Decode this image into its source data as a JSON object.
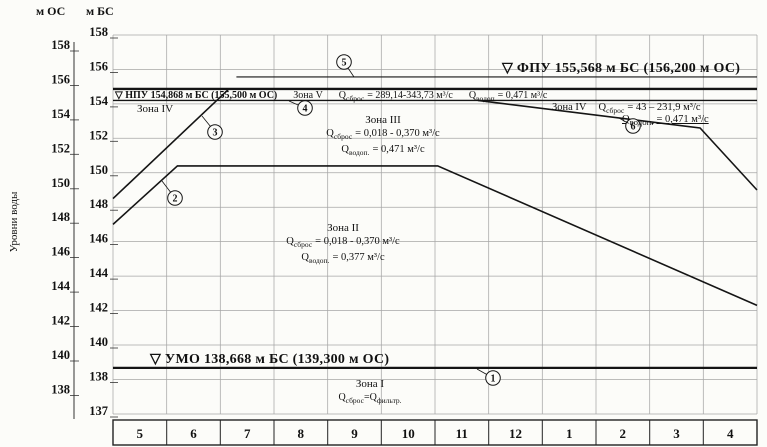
{
  "annotations": {
    "q_letter": "Q",
    "fpu_label": "▽ ФПУ 155,568 м БС (156,200 м ОС)",
    "npu_label": "▽ НПУ 154,868 м БС (155,500 м ОС)",
    "umo_label": "▽ УМО 138,668 м БС (139,300 м ОС)",
    "zone5": {
      "title": "Зона V",
      "q1_sub": "сброс",
      "q1_val": "= 289,14-343,73 м³/с",
      "q2_sub": "водоп",
      "q2_val": "= 0,471 м³/с"
    },
    "zone4_left": {
      "title": "Зона IV"
    },
    "zone4_right": {
      "title": "Зона IV",
      "q1_sub": "сброс",
      "q1_val": "= 43 – 231,9 м³/с",
      "q2_sub": "водоп.",
      "q2_val": "= 0,471 м³/с"
    },
    "zone3": {
      "title": "Зона III",
      "q1_sub": "сброс",
      "q1_val": "= 0,018 - 0,370 м³/с",
      "q2_sub": "водоп.",
      "q2_val": "= 0,471 м³/с"
    },
    "zone2": {
      "title": "Зона II",
      "q1_sub": "сброс",
      "q1_val": "= 0,018 - 0,370 м³/с",
      "q2_sub": "водоп.",
      "q2_val": "= 0,377 м³/с"
    },
    "zone1": {
      "title": "Зона I",
      "q_left_sub": "сброс",
      "eq": "=",
      "q_right_sub": "фильтр."
    }
  },
  "chart_data": {
    "type": "line",
    "title": "Диспетчерский график водохранилища (уровни воды по месяцам)",
    "ylabel": "Уровни воды",
    "y_axis_left": {
      "title": "м ОС",
      "ticks": [
        158,
        156,
        154,
        152,
        150,
        148,
        146,
        144,
        142,
        140,
        138
      ]
    },
    "y_axis_right": {
      "title": "м БС",
      "ticks": [
        158,
        156,
        154,
        152,
        150,
        148,
        146,
        144,
        142,
        140,
        138,
        137
      ]
    },
    "x_axis": {
      "months": [
        "5",
        "6",
        "7",
        "8",
        "9",
        "10",
        "11",
        "12",
        "1",
        "2",
        "3",
        "4"
      ]
    },
    "levels": {
      "FPU_BS": 155.568,
      "FPU_OS": 156.2,
      "NPU_BS": 154.868,
      "NPU_OS": 155.5,
      "UMO_BS": 138.668,
      "UMO_OS": 139.3
    },
    "grid": true,
    "legend": "none",
    "series": [
      {
        "id": "line-1-umo",
        "points": [
          [
            0,
            138.668
          ],
          [
            12,
            138.668
          ]
        ],
        "width": 2.2
      },
      {
        "id": "line-2-lower",
        "points": [
          [
            0,
            147.0
          ],
          [
            1.2,
            150.4
          ],
          [
            6.05,
            150.4
          ],
          [
            12,
            142.3
          ]
        ],
        "width": 1.6
      },
      {
        "id": "line-3-filling",
        "points": [
          [
            0,
            148.5
          ],
          [
            2.16,
            154.868
          ]
        ],
        "width": 1.6
      },
      {
        "id": "line-4-upper",
        "points": [
          [
            0,
            154.2
          ],
          [
            12,
            154.2
          ]
        ],
        "width": 1.4
      },
      {
        "id": "line-5-fpu",
        "points": [
          [
            2.3,
            155.568
          ],
          [
            12,
            155.568
          ]
        ],
        "width": 1.1
      },
      {
        "id": "line-6-zone4",
        "points": [
          [
            6.8,
            154.2
          ],
          [
            10.94,
            152.6
          ],
          [
            12,
            149.0
          ]
        ],
        "width": 1.6
      },
      {
        "id": "line-npu",
        "points": [
          [
            0,
            154.868
          ],
          [
            12,
            154.868
          ]
        ],
        "width": 2.4
      }
    ],
    "markers": [
      {
        "label": "1",
        "cx": 493,
        "cy": 378,
        "lx": 477,
        "ly": 369
      },
      {
        "label": "2",
        "cx": 175,
        "cy": 198,
        "lx": 162,
        "ly": 181
      },
      {
        "label": "3",
        "cx": 215,
        "cy": 132,
        "lx": 202,
        "ly": 116
      },
      {
        "label": "4",
        "cx": 305,
        "cy": 108,
        "lx": 289,
        "ly": 101
      },
      {
        "label": "5",
        "cx": 344,
        "cy": 62,
        "lx": 354,
        "ly": 77
      },
      {
        "label": "6",
        "cx": 633,
        "cy": 126,
        "lx": 619,
        "ly": 118
      }
    ]
  }
}
